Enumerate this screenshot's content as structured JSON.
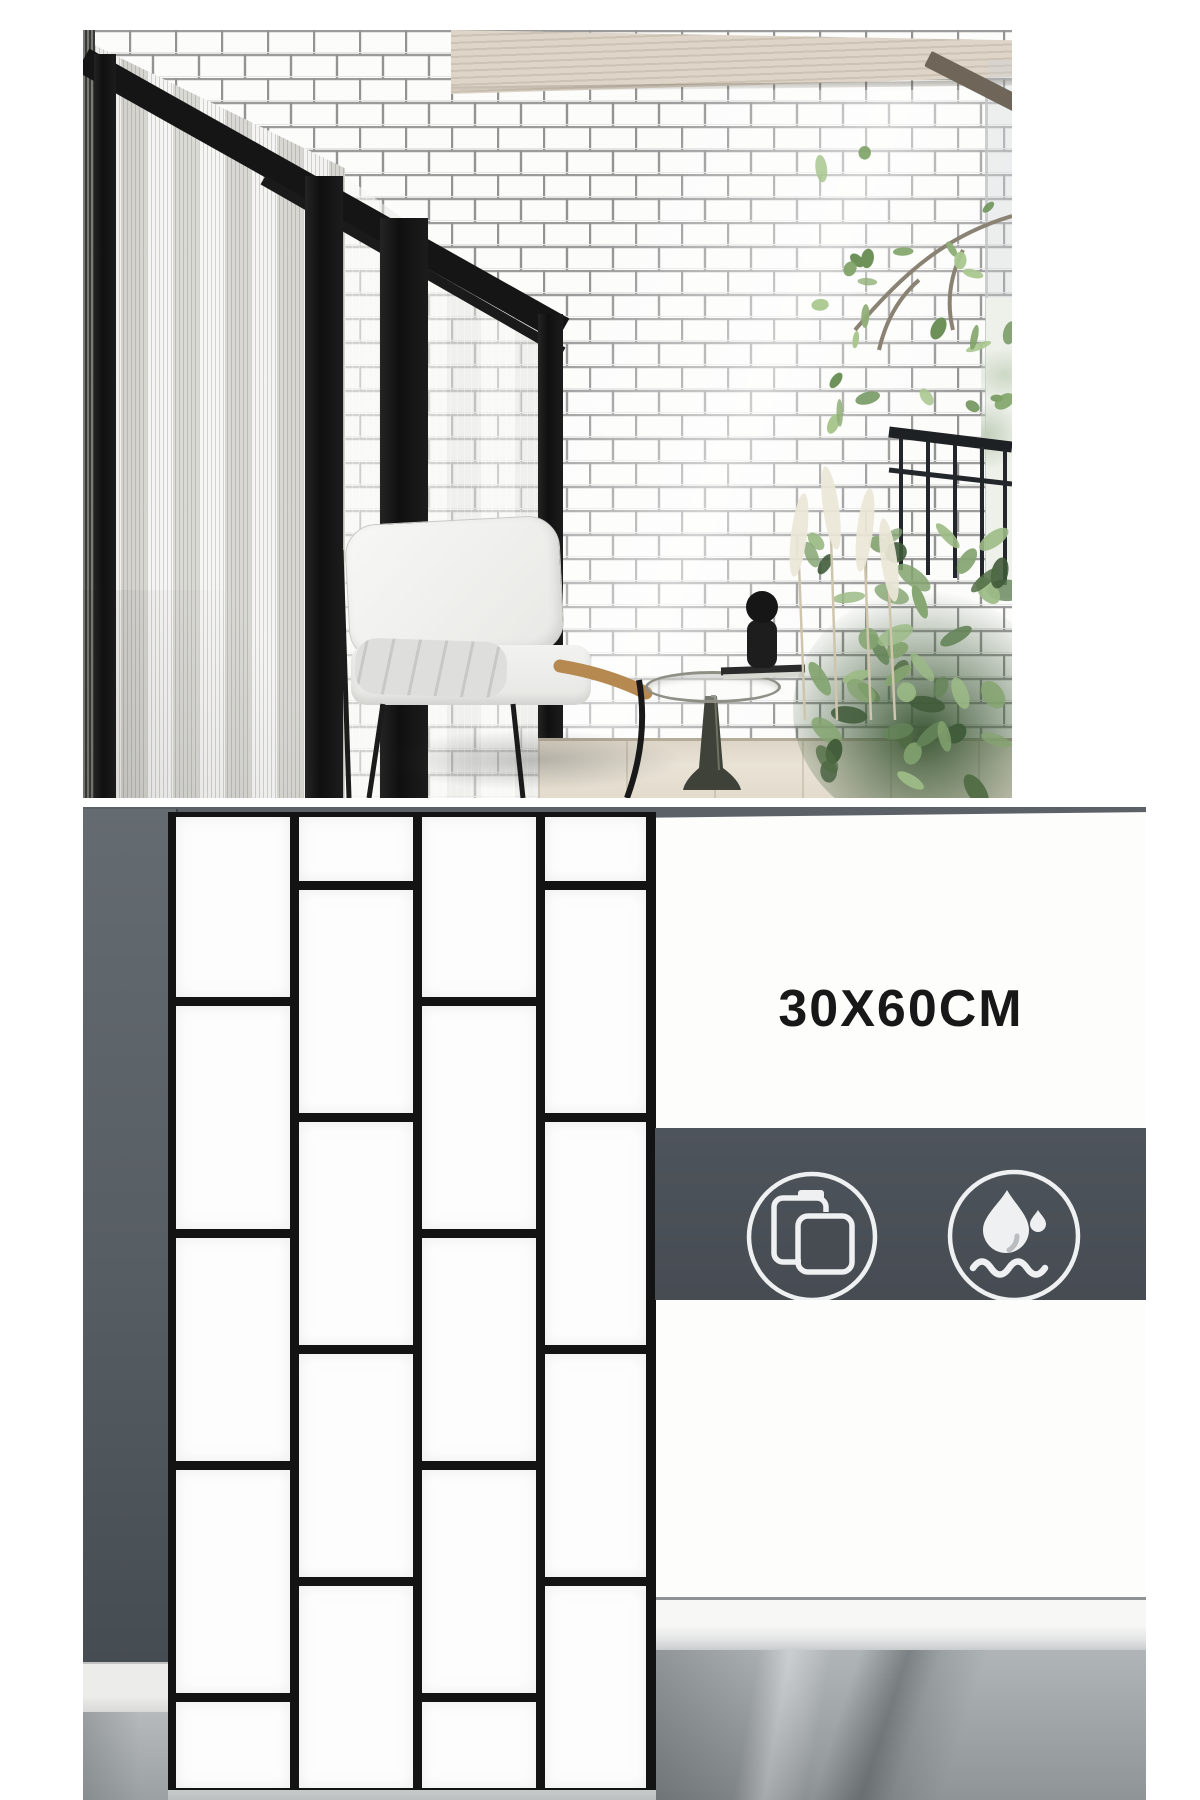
{
  "product": {
    "size_label": "30X60CM",
    "tile_color": "#fdfdfd",
    "grout_color": "#131313"
  },
  "banner": {
    "background": "#4a5056",
    "icons": [
      {
        "name": "tile-copy-icon",
        "meaning": "stacked tiles / easy install"
      },
      {
        "name": "waterproof-icon",
        "meaning": "waterproof"
      }
    ]
  },
  "colors": {
    "left_wall_gray": "#565d63",
    "top_band_gray": "#5b6167",
    "marble_floor": "#9aa0a3",
    "baseboard": "#f7f7f5",
    "photo_grout": "#9b9b9b",
    "door_frame_black": "#141414",
    "ceiling_wood": "#d6ccbe",
    "plant_green": "#6f8f5c",
    "armrest_gold": "#b5894f"
  },
  "tile_panel": {
    "grout_px": 9,
    "columns": [
      {
        "x": 176,
        "width": 114,
        "cells": [
          [
            817,
            180
          ],
          [
            1006,
            223
          ],
          [
            1238,
            223
          ],
          [
            1470,
            223
          ],
          [
            1702,
            86
          ]
        ]
      },
      {
        "x": 299,
        "width": 114,
        "cells": [
          [
            817,
            64
          ],
          [
            890,
            223
          ],
          [
            1122,
            223
          ],
          [
            1354,
            223
          ],
          [
            1586,
            202
          ]
        ]
      },
      {
        "x": 422,
        "width": 114,
        "cells": [
          [
            817,
            180
          ],
          [
            1006,
            223
          ],
          [
            1238,
            223
          ],
          [
            1470,
            223
          ],
          [
            1702,
            86
          ]
        ]
      },
      {
        "x": 545,
        "width": 101,
        "cells": [
          [
            817,
            64
          ],
          [
            890,
            223
          ],
          [
            1122,
            223
          ],
          [
            1354,
            223
          ],
          [
            1586,
            202
          ]
        ]
      }
    ],
    "origin": {
      "x": 83,
      "y": 807
    }
  },
  "scene": {
    "branch_leaves": {
      "count": 26,
      "box": [
        736,
        120,
        193,
        300
      ],
      "palette": [
        "#8fae77",
        "#6d9158",
        "#a9c78f",
        "#7ea265"
      ]
    },
    "bush_leaves": {
      "count": 48,
      "box": [
        726,
        505,
        203,
        258
      ],
      "palette": [
        "#4f6b43",
        "#66855a",
        "#84a470",
        "#9cbb86",
        "#3f5a38"
      ]
    },
    "pampas": {
      "plumes": [
        [
          716,
          505
        ],
        [
          748,
          478
        ],
        [
          782,
          500
        ],
        [
          806,
          530
        ]
      ],
      "color": "#ece7d7"
    }
  }
}
